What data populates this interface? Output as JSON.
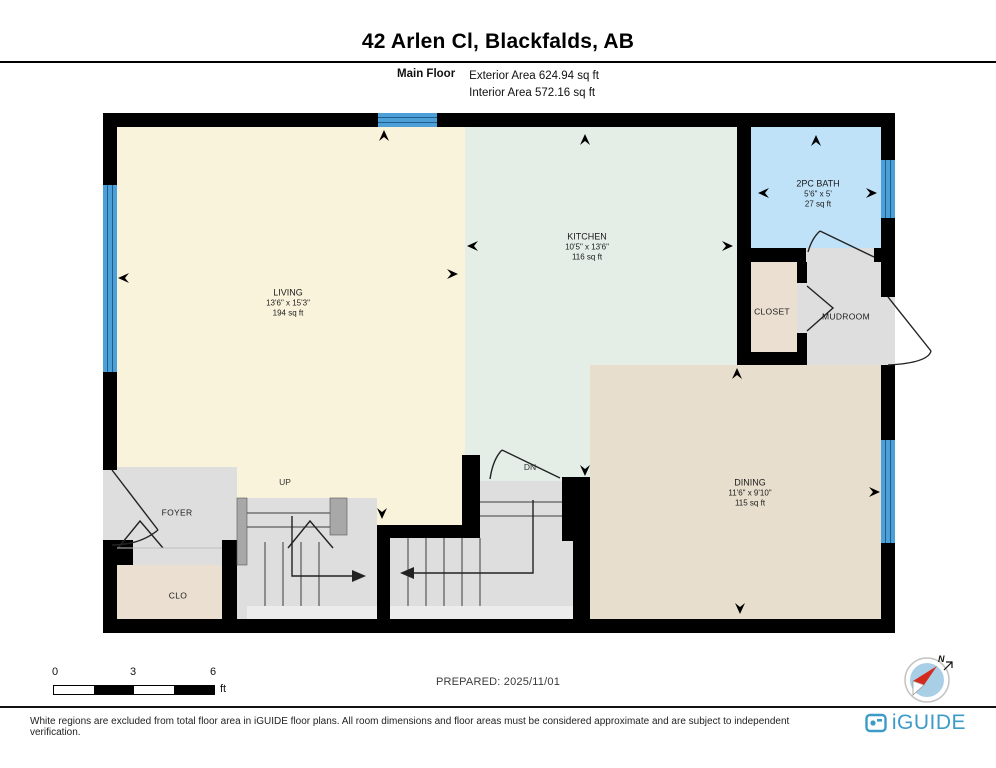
{
  "header": {
    "title": "42 Arlen Cl, Blackfalds, AB",
    "floor_label": "Main Floor",
    "exterior_area": "Exterior Area 624.94 sq ft",
    "interior_area": "Interior Area 572.16 sq ft"
  },
  "plan": {
    "rooms": {
      "living": {
        "name": "LIVING",
        "dims": "13'6\" x 15'3\"",
        "area": "194 sq ft"
      },
      "kitchen": {
        "name": "KITCHEN",
        "dims": "10'5\" x 13'6\"",
        "area": "116 sq ft"
      },
      "bath": {
        "name": "2PC BATH",
        "dims": "5'6\" x 5'",
        "area": "27 sq ft"
      },
      "dining": {
        "name": "DINING",
        "dims": "11'6\" x 9'10\"",
        "area": "115 sq ft"
      },
      "closet": {
        "name": "CLOSET"
      },
      "mudroom": {
        "name": "MUDROOM"
      },
      "foyer": {
        "name": "FOYER"
      },
      "clo": {
        "name": "CLO"
      }
    },
    "up_label": "UP",
    "dn_label": "DN"
  },
  "scale_bar": {
    "ticks": [
      "0",
      "3",
      "6"
    ],
    "unit": "ft"
  },
  "prepared_label": "PREPARED: 2025/11/01",
  "compass": {
    "north": "N"
  },
  "footer": {
    "disclaimer": "White regions are excluded from total floor area in iGUIDE floor plans. All room dimensions and floor areas must be considered approximate and are subject to independent verification.",
    "brand": "iGUIDE"
  },
  "colors": {
    "wall": "#000000",
    "living_fill": "#FAF3DC",
    "kitchen_fill": "#E4EDE6",
    "bath_fill": "#BFE2F8",
    "dining_fill": "#E7DECD",
    "closet_fill": "#EADFD0",
    "gray_fill": "#DEDEDE",
    "window_blue": "#4DA0D7",
    "brand_blue": "#3D9BC8",
    "compass_red": "#D42B1E"
  }
}
